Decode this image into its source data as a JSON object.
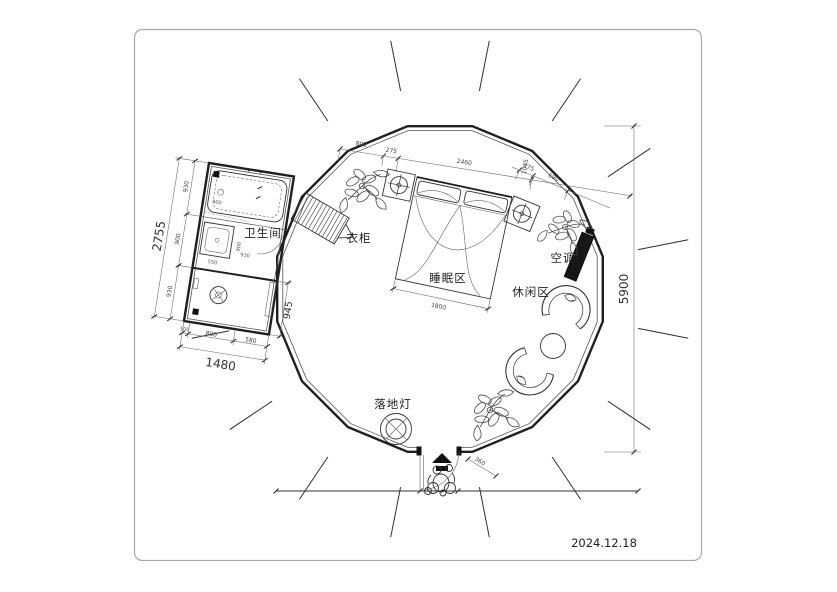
{
  "title": "round-cabin-floor-plan",
  "date": "2024.12.18",
  "labels": {
    "bathroom": "卫生间",
    "wardrobe": "衣柜",
    "sleeping": "睡眠区",
    "leisure": "休闲区",
    "ac": "空调",
    "floor_lamp": "落地灯"
  },
  "dims": {
    "top_chain": {
      "a": "805",
      "b": "275",
      "c": "2460",
      "c_alt": "1045"
    },
    "right_chain": {
      "a": "275",
      "b": "690"
    },
    "overall_height": "5900",
    "bed_width": "1800",
    "door_width": "360",
    "bathroom": {
      "total_h": "2755",
      "h1": "930",
      "h2": "900",
      "h3": "930",
      "total_w": "1480",
      "w1": "100",
      "w2": "800",
      "w3": "580",
      "side": "945",
      "sink_w": "550",
      "tub_w": "400",
      "inner_w": "930",
      "inner_h": "900"
    }
  }
}
